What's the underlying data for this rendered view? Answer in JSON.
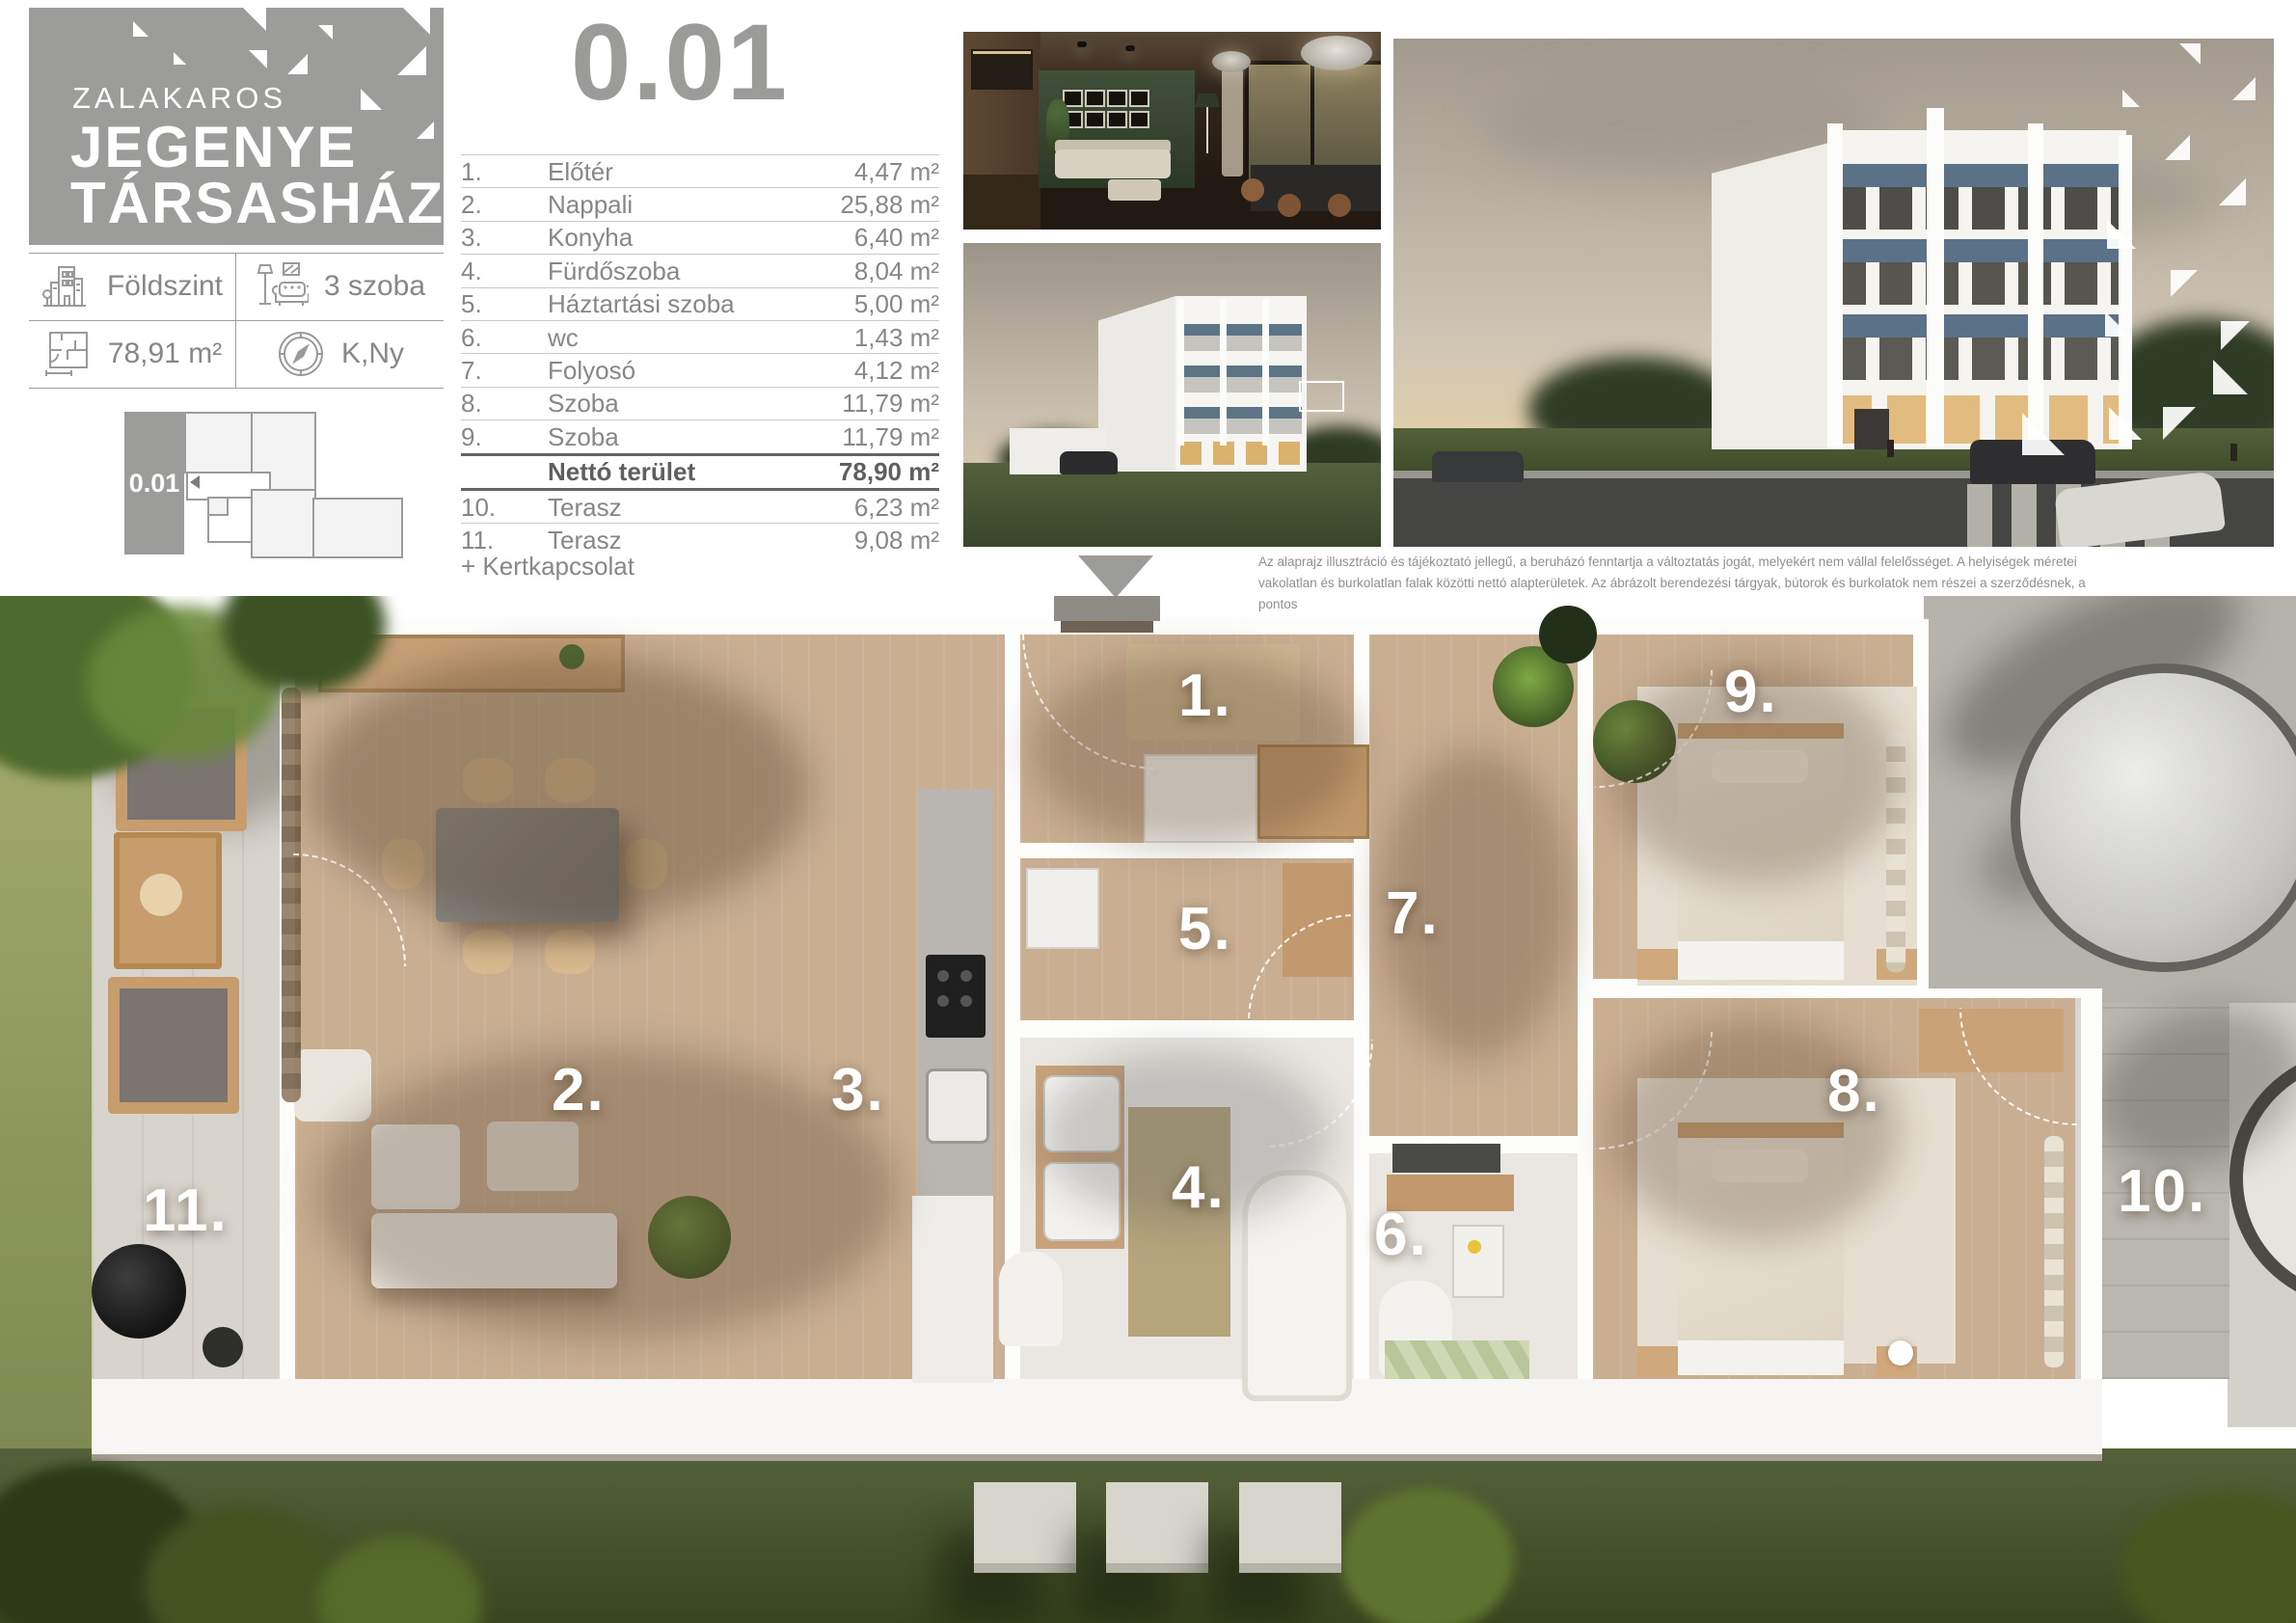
{
  "logo": {
    "city": "ZALAKAROS",
    "name_line1": "JEGENYE",
    "name_line2": "TÁRSASHÁZ"
  },
  "unit_title": "0.01",
  "info_cells": [
    {
      "icon": "building-icon",
      "label": "Földszint"
    },
    {
      "icon": "sofa-lamp-icon",
      "label": "3 szoba"
    },
    {
      "icon": "floorplan-icon",
      "label": "78,91 m²"
    },
    {
      "icon": "compass-icon",
      "label": "K,Ny"
    }
  ],
  "site_locator": {
    "unit_id": "0.01"
  },
  "room_table": {
    "rows": [
      {
        "no": "1.",
        "name": "Előtér",
        "area": "4,47 m²"
      },
      {
        "no": "2.",
        "name": "Nappali",
        "area": "25,88 m²"
      },
      {
        "no": "3.",
        "name": "Konyha",
        "area": "6,40 m²"
      },
      {
        "no": "4.",
        "name": "Fürdőszoba",
        "area": "8,04 m²"
      },
      {
        "no": "5.",
        "name": "Háztartási szoba",
        "area": "5,00 m²"
      },
      {
        "no": "6.",
        "name": "wc",
        "area": "1,43 m²"
      },
      {
        "no": "7.",
        "name": "Folyosó",
        "area": "4,12 m²"
      },
      {
        "no": "8.",
        "name": "Szoba",
        "area": "11,79 m²"
      },
      {
        "no": "9.",
        "name": "Szoba",
        "area": "11,79 m²"
      }
    ],
    "total_row": {
      "no": "",
      "name": "Nettó terület",
      "area": "78,90 m²"
    },
    "terrace_rows": [
      {
        "no": "10.",
        "name": "Terasz",
        "area": "6,23 m²"
      },
      {
        "no": "11.",
        "name": "Terasz",
        "area": "9,08 m²"
      }
    ],
    "note": "+ Kertkapcsolat"
  },
  "disclaimer": "Az alaprajz illusztráció és tájékoztató jellegű, a beruházó fenntartja a változtatás jogát, melyekért nem vállal felelősséget. A helyiségek méretei\nvakolatlan és burkolatlan falak közötti nettó alapterületek. Az ábrázolt berendezési tárgyak, bútorok és burkolatok nem részei a szerződésnek, a pontos\nfelszereltség a műszaki leírásban található.",
  "plan_labels": [
    {
      "text": "1."
    },
    {
      "text": "2."
    },
    {
      "text": "3."
    },
    {
      "text": "4."
    },
    {
      "text": "5."
    },
    {
      "text": "6."
    },
    {
      "text": "7."
    },
    {
      "text": "8."
    },
    {
      "text": "9."
    },
    {
      "text": "10."
    },
    {
      "text": "11."
    }
  ],
  "colors": {
    "brand_gray": "#9c9c9b",
    "text_gray": "#878787",
    "balcony_blue": "#5d7487",
    "wood_floor": "#c9ae92"
  }
}
